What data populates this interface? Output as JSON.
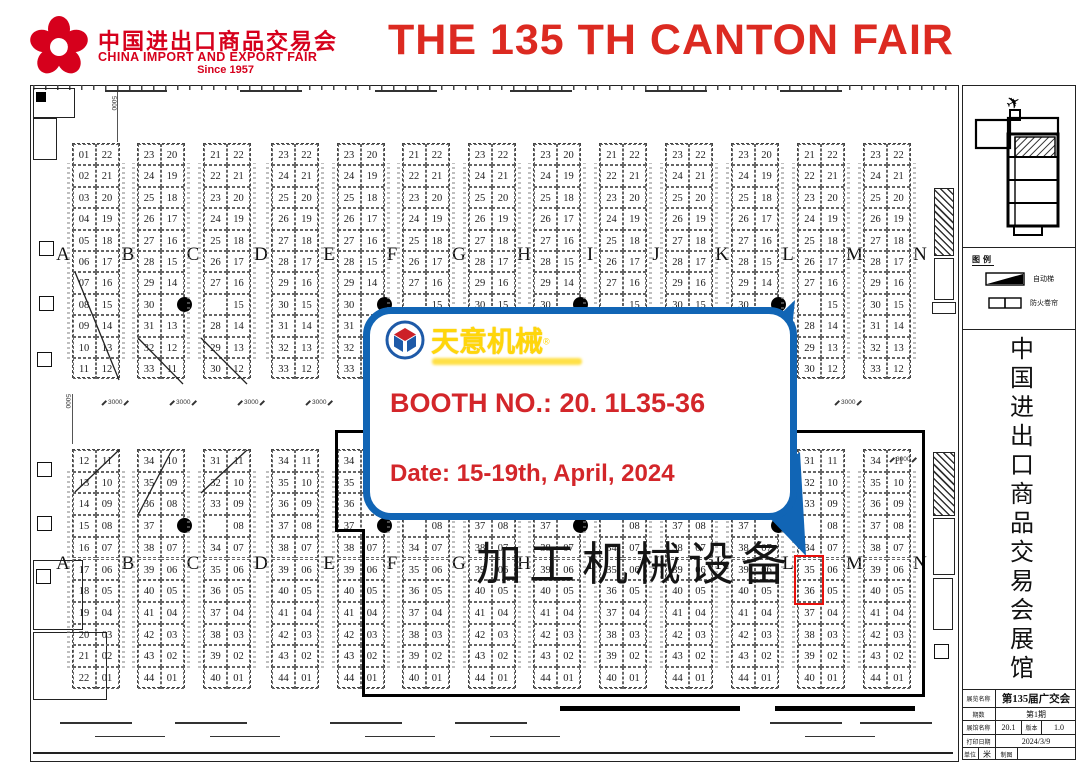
{
  "header": {
    "logo_cn": "中国进出口商品交易会",
    "logo_en": "CHINA IMPORT AND EXPORT FAIR",
    "logo_since": "Since 1957",
    "title": "THE 135 TH CANTON FAIR",
    "brand_red": "#d6001c",
    "title_red": "#dc2a21"
  },
  "callout": {
    "brand": "天意机械",
    "brand_reg": "®",
    "booth_line": "BOOTH NO.: 20. 1L35-36",
    "date_line": "Date: 15-19th, April, 2024",
    "border_blue": "#1165b5",
    "text_red": "#d3262a",
    "brand_yellow": "#ffd60a"
  },
  "overlay_text": "加工机械设备",
  "floorplan": {
    "letters": [
      "A",
      "B",
      "C",
      "D",
      "E",
      "F",
      "G",
      "H",
      "I",
      "J",
      "K",
      "L",
      "M",
      "N"
    ],
    "dim_labels": {
      "h": "3000",
      "v": "5000"
    },
    "highlight": {
      "hall": "20.1",
      "booths": [
        "35",
        "36"
      ],
      "aisle": "L",
      "color": "#e8100c"
    },
    "top_groups": [
      {
        "id": "A-B",
        "left": [
          "01",
          "02",
          "03",
          "04",
          "05",
          "06",
          "07",
          "08",
          "09",
          "10",
          "11"
        ],
        "right": [
          "22",
          "21",
          "20",
          "19",
          "18",
          "17",
          "16",
          "15",
          "14",
          "13",
          "12"
        ]
      },
      {
        "id": "B-C",
        "left": [
          "23",
          "24",
          "25",
          "26",
          "27",
          "28",
          "29",
          "30",
          "31",
          "32",
          "33"
        ],
        "right": [
          "20",
          "19",
          "18",
          "17",
          "16",
          "15",
          "14",
          "●",
          "13",
          "12",
          "11"
        ]
      },
      {
        "id": "C-D",
        "left": [
          "21",
          "22",
          "23",
          "24",
          "25",
          "26",
          "27",
          "",
          "28",
          "29",
          "30"
        ],
        "right": [
          "22",
          "21",
          "20",
          "19",
          "18",
          "17",
          "16",
          "15",
          "14",
          "13",
          "12"
        ]
      },
      {
        "id": "D-E",
        "left": [
          "23",
          "24",
          "25",
          "26",
          "27",
          "28",
          "29",
          "30",
          "31",
          "32",
          "33"
        ],
        "right": [
          "22",
          "21",
          "20",
          "19",
          "18",
          "17",
          "16",
          "15",
          "14",
          "13",
          "12"
        ]
      },
      {
        "id": "E-F",
        "left": [
          "23",
          "24",
          "25",
          "26",
          "27",
          "28",
          "29",
          "30",
          "31",
          "32",
          "33"
        ],
        "right": [
          "20",
          "19",
          "18",
          "17",
          "16",
          "15",
          "14",
          "●",
          "13",
          "12",
          "11"
        ]
      },
      {
        "id": "F-G",
        "left": [
          "21",
          "22",
          "23",
          "24",
          "25",
          "26",
          "27",
          "",
          "28",
          "29",
          "30"
        ],
        "right": [
          "22",
          "21",
          "20",
          "19",
          "18",
          "17",
          "16",
          "15",
          "14",
          "13",
          "12"
        ]
      },
      {
        "id": "G-H",
        "left": [
          "23",
          "24",
          "25",
          "26",
          "27",
          "28",
          "29",
          "30",
          "31",
          "32",
          "33"
        ],
        "right": [
          "22",
          "21",
          "20",
          "19",
          "18",
          "17",
          "16",
          "15",
          "14",
          "13",
          "12"
        ]
      },
      {
        "id": "H-I",
        "left": [
          "23",
          "24",
          "25",
          "26",
          "27",
          "28",
          "29",
          "30",
          "31",
          "32",
          "33"
        ],
        "right": [
          "20",
          "19",
          "18",
          "17",
          "16",
          "15",
          "14",
          "●",
          "13",
          "12",
          "11"
        ]
      },
      {
        "id": "I-J",
        "left": [
          "21",
          "22",
          "23",
          "24",
          "25",
          "26",
          "27",
          "",
          "28",
          "29",
          "30"
        ],
        "right": [
          "22",
          "21",
          "20",
          "19",
          "18",
          "17",
          "16",
          "15",
          "14",
          "13",
          "12"
        ]
      },
      {
        "id": "J-K",
        "left": [
          "23",
          "24",
          "25",
          "26",
          "27",
          "28",
          "29",
          "30",
          "31",
          "32",
          "33"
        ],
        "right": [
          "22",
          "21",
          "20",
          "19",
          "18",
          "17",
          "16",
          "15",
          "14",
          "13",
          "12"
        ]
      },
      {
        "id": "K-L",
        "left": [
          "23",
          "24",
          "25",
          "26",
          "27",
          "28",
          "29",
          "30",
          "31",
          "32",
          "33"
        ],
        "right": [
          "20",
          "19",
          "18",
          "17",
          "16",
          "15",
          "14",
          "●",
          "13",
          "12",
          "11"
        ]
      },
      {
        "id": "L-M",
        "left": [
          "21",
          "22",
          "23",
          "24",
          "25",
          "26",
          "27",
          "",
          "28",
          "29",
          "30"
        ],
        "right": [
          "22",
          "21",
          "20",
          "19",
          "18",
          "17",
          "16",
          "15",
          "14",
          "13",
          "12"
        ]
      },
      {
        "id": "M-N",
        "left": [
          "23",
          "24",
          "25",
          "26",
          "27",
          "28",
          "29",
          "30",
          "31",
          "32",
          "33"
        ],
        "right": [
          "22",
          "21",
          "20",
          "19",
          "18",
          "17",
          "16",
          "15",
          "14",
          "13",
          "12"
        ]
      }
    ],
    "bottom_groups": [
      {
        "id": "A-B",
        "left": [
          "12",
          "13",
          "14",
          "15",
          "16",
          "17",
          "18",
          "19",
          "20",
          "21",
          "22"
        ],
        "right": [
          "11",
          "10",
          "09",
          "08",
          "07",
          "06",
          "05",
          "04",
          "03",
          "02",
          "01"
        ]
      },
      {
        "id": "B-C",
        "left": [
          "34",
          "35",
          "36",
          "37",
          "38",
          "39",
          "40",
          "41",
          "42",
          "43",
          "44"
        ],
        "right": [
          "10",
          "09",
          "08",
          "●",
          "07",
          "06",
          "05",
          "04",
          "03",
          "02",
          "01"
        ]
      },
      {
        "id": "C-D",
        "left": [
          "31",
          "32",
          "33",
          "",
          "34",
          "35",
          "36",
          "37",
          "38",
          "39",
          "40"
        ],
        "right": [
          "11",
          "10",
          "09",
          "08",
          "07",
          "06",
          "05",
          "04",
          "03",
          "02",
          "01"
        ]
      },
      {
        "id": "D-E",
        "left": [
          "34",
          "35",
          "36",
          "37",
          "38",
          "39",
          "40",
          "41",
          "42",
          "43",
          "44"
        ],
        "right": [
          "11",
          "10",
          "09",
          "08",
          "07",
          "06",
          "05",
          "04",
          "03",
          "02",
          "01"
        ]
      },
      {
        "id": "E-F",
        "left": [
          "34",
          "35",
          "36",
          "37",
          "38",
          "39",
          "40",
          "41",
          "42",
          "43",
          "44"
        ],
        "right": [
          "10",
          "09",
          "08",
          "●",
          "07",
          "06",
          "05",
          "04",
          "03",
          "02",
          "01"
        ]
      },
      {
        "id": "F-G",
        "left": [
          "31",
          "32",
          "33",
          "",
          "34",
          "35",
          "36",
          "37",
          "38",
          "39",
          "40"
        ],
        "right": [
          "11",
          "10",
          "09",
          "08",
          "07",
          "06",
          "05",
          "04",
          "03",
          "02",
          "01"
        ]
      },
      {
        "id": "G-H",
        "left": [
          "34",
          "35",
          "36",
          "37",
          "38",
          "39",
          "40",
          "41",
          "42",
          "43",
          "44"
        ],
        "right": [
          "11",
          "10",
          "09",
          "08",
          "07",
          "06",
          "05",
          "04",
          "03",
          "02",
          "01"
        ]
      },
      {
        "id": "H-I",
        "left": [
          "34",
          "35",
          "36",
          "37",
          "38",
          "39",
          "40",
          "41",
          "42",
          "43",
          "44"
        ],
        "right": [
          "10",
          "09",
          "08",
          "●",
          "07",
          "06",
          "05",
          "04",
          "03",
          "02",
          "01"
        ]
      },
      {
        "id": "I-J",
        "left": [
          "31",
          "32",
          "33",
          "",
          "34",
          "35",
          "36",
          "37",
          "38",
          "39",
          "40"
        ],
        "right": [
          "11",
          "10",
          "09",
          "08",
          "07",
          "06",
          "05",
          "04",
          "03",
          "02",
          "01"
        ]
      },
      {
        "id": "J-K",
        "left": [
          "34",
          "35",
          "36",
          "37",
          "38",
          "39",
          "40",
          "41",
          "42",
          "43",
          "44"
        ],
        "right": [
          "11",
          "10",
          "09",
          "08",
          "07",
          "06",
          "05",
          "04",
          "03",
          "02",
          "01"
        ]
      },
      {
        "id": "K-L",
        "left": [
          "34",
          "35",
          "36",
          "37",
          "38",
          "39",
          "40",
          "41",
          "42",
          "43",
          "44"
        ],
        "right": [
          "10",
          "09",
          "08",
          "●",
          "07",
          "06",
          "05",
          "04",
          "03",
          "02",
          "01"
        ]
      },
      {
        "id": "L-M",
        "left": [
          "31",
          "32",
          "33",
          "",
          "34",
          "35",
          "36",
          "37",
          "38",
          "39",
          "40"
        ],
        "right": [
          "11",
          "10",
          "09",
          "08",
          "07",
          "06",
          "05",
          "04",
          "03",
          "02",
          "01"
        ]
      },
      {
        "id": "M-N",
        "left": [
          "34",
          "35",
          "36",
          "37",
          "38",
          "39",
          "40",
          "41",
          "42",
          "43",
          "44"
        ],
        "right": [
          "11",
          "10",
          "09",
          "08",
          "07",
          "06",
          "05",
          "04",
          "03",
          "02",
          "01"
        ]
      }
    ]
  },
  "sidebar": {
    "legend_title": "图例",
    "legend_items": [
      {
        "label": "自动梯"
      },
      {
        "label": "防火卷帘"
      }
    ],
    "vertical_title": "中国进出口商品交易会展馆",
    "title_block": {
      "rows": [
        [
          "展览名称",
          "第135届广交会"
        ],
        [
          "期数",
          "第1期"
        ],
        [
          "展馆名称",
          "20.1",
          "版本",
          "1.0"
        ],
        [
          "打印日期",
          "2024/3/9"
        ],
        [
          "单位",
          "米",
          "制图",
          ""
        ]
      ]
    }
  }
}
